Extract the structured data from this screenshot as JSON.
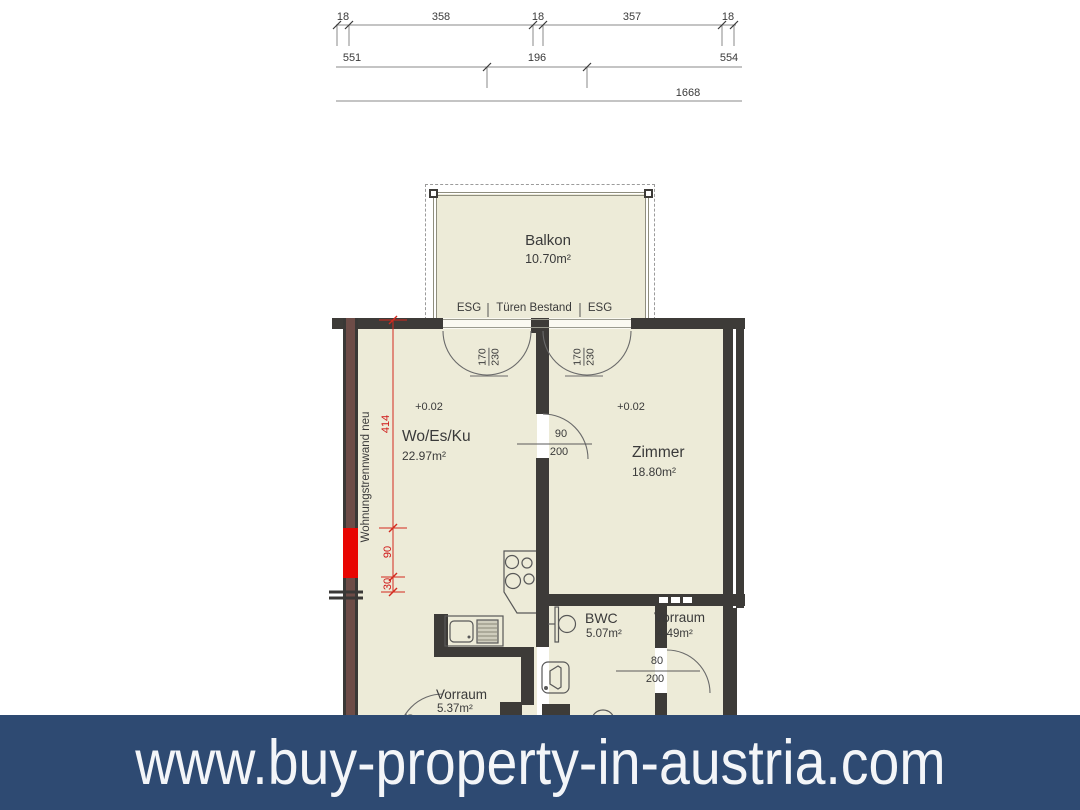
{
  "banner": {
    "url": "www.buy-property-in-austria.com",
    "bg_color": "#2e4a72",
    "text_color": "#f3f5f8"
  },
  "dim_rows": {
    "row1": [
      "18",
      "358",
      "18",
      "357",
      "18"
    ],
    "row2": [
      "551",
      "196",
      "554"
    ],
    "row3_total": "1668"
  },
  "balcony": {
    "name": "Balkon",
    "area": "10.70m²"
  },
  "glazing": {
    "left": "ESG",
    "center": "Türen Bestand",
    "right": "ESG"
  },
  "rooms": {
    "living": {
      "level": "+0.02",
      "name": "Wo/Es/Ku",
      "area": "22.97m²"
    },
    "bedroom": {
      "level": "+0.02",
      "name": "Zimmer",
      "area": "18.80m²"
    },
    "bwc": {
      "name": "BWC",
      "area": "5.07m²"
    },
    "hall_right": {
      "name": "Vorraum",
      "area": "4.49m²"
    },
    "hall_bottom": {
      "name": "Vorraum",
      "area": "5.37m²"
    }
  },
  "doors": {
    "balcony_left": {
      "width": "170",
      "height": "230"
    },
    "balcony_right": {
      "width": "170",
      "height": "230"
    },
    "bedroom": {
      "width": "90",
      "height": "200"
    },
    "hall": {
      "width": "80",
      "height": "200"
    },
    "hall_bottom": {
      "width": "80",
      "height": "200"
    }
  },
  "annotations": {
    "partition_wall": "Wohnungstrennwand neu",
    "red_dim_total": "414",
    "red_dim_mid": "90",
    "red_dim_small": "30"
  },
  "colors": {
    "wall": "#3d3b38",
    "partition_wall": "#6d4c47",
    "highlight_red": "#e80602",
    "floor": "#edebd8",
    "banner_bg": "#2e4a72",
    "linework": "#6a6a6a"
  }
}
